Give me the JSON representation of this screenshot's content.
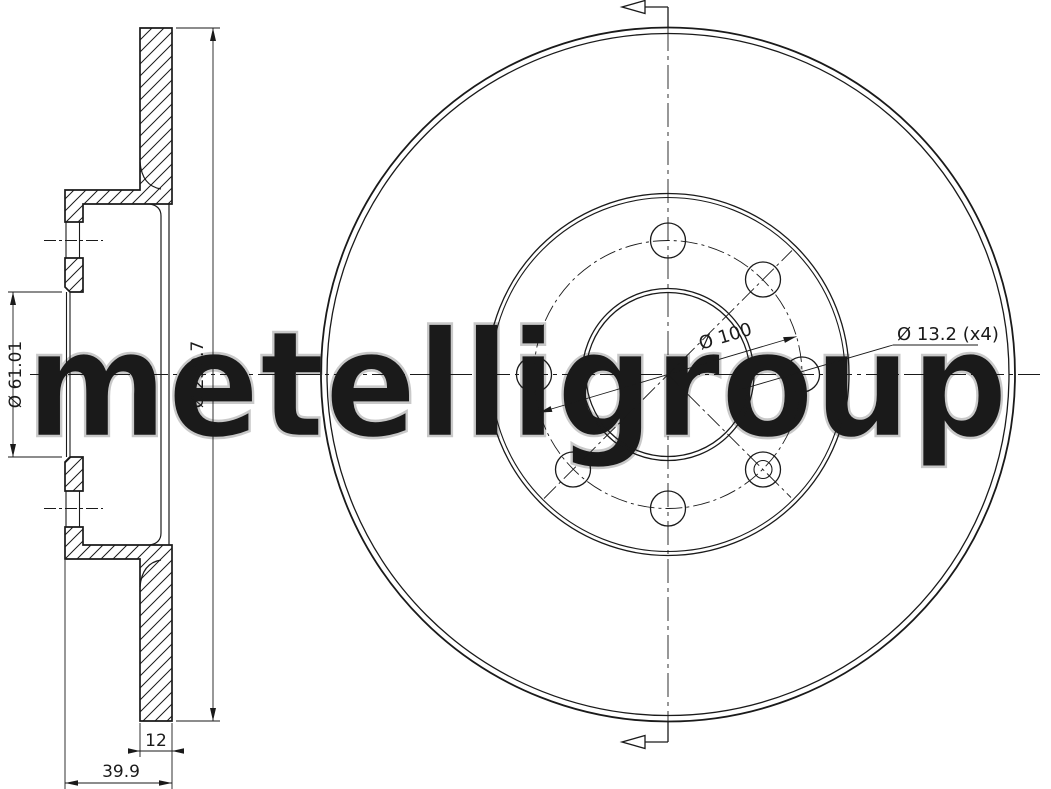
{
  "style": {
    "background": "#ffffff",
    "line_color": "#1a1a1a",
    "watermark_color": "#c9c9c9"
  },
  "watermark": {
    "text": "metelligroup"
  },
  "views": {
    "section": {
      "title": "side-section-view",
      "dims": {
        "outer_diameter": "Ø 259.7",
        "bore": "Ø 61.01",
        "thickness": "12",
        "width": "39.9"
      }
    },
    "front": {
      "title": "front-view",
      "dims": {
        "pcd": "Ø 100",
        "bolt_holes": "Ø 13.2 (x4)"
      }
    }
  }
}
